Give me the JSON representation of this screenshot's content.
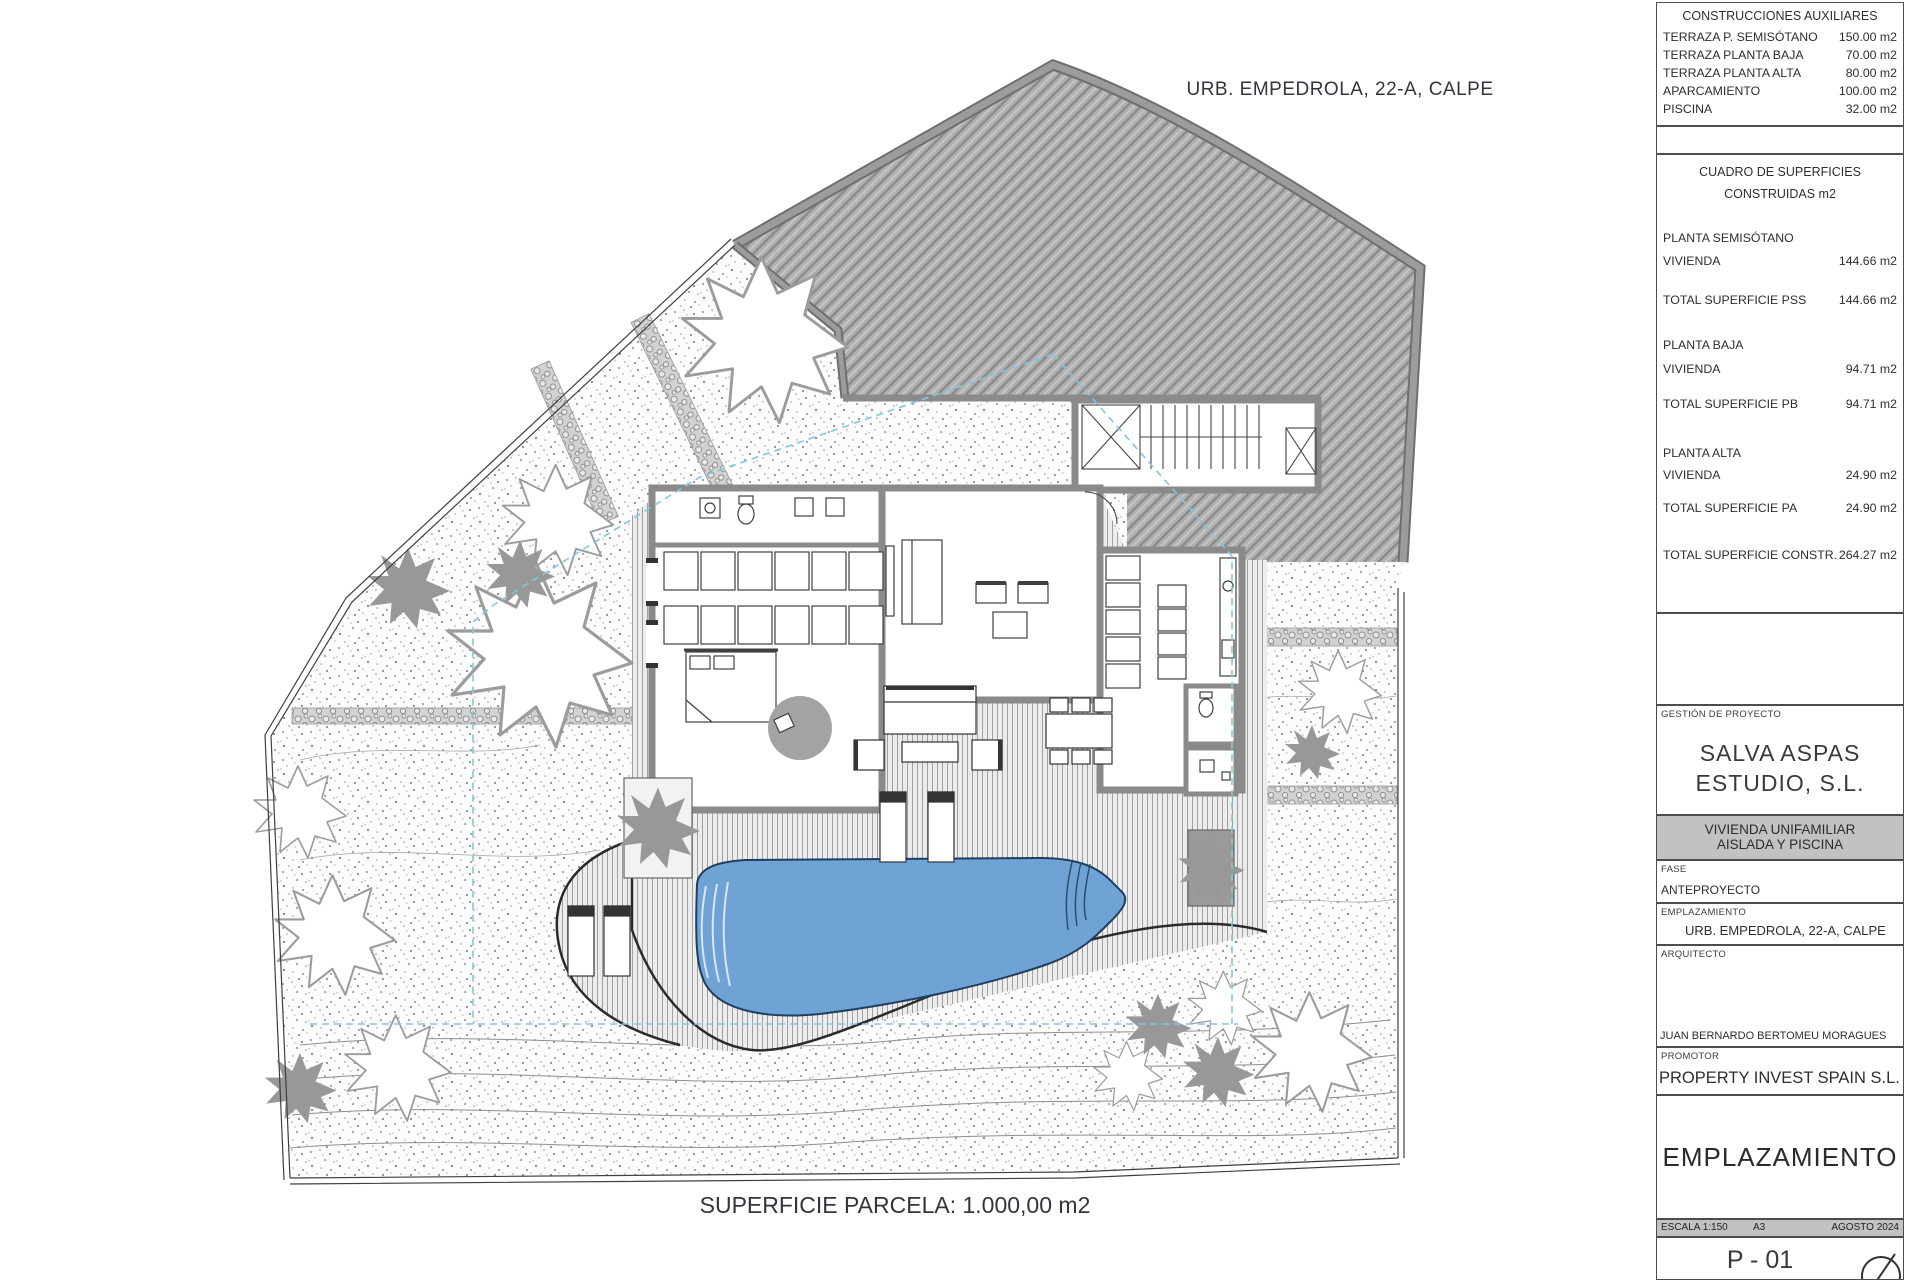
{
  "drawing": {
    "site_label": "URB. EMPEDROLA, 22-A, CALPE",
    "parcel_label": "SUPERFICIE PARCELA: 1.000,00 m2"
  },
  "title_block": {
    "aux_table": {
      "title": "CONSTRUCCIONES AUXILIARES",
      "rows": [
        {
          "label": "TERRAZA P. SEMISÓTANO",
          "value": "150.00 m2"
        },
        {
          "label": "TERRAZA PLANTA BAJA",
          "value": "70.00 m2"
        },
        {
          "label": "TERRAZA PLANTA ALTA",
          "value": "80.00 m2"
        },
        {
          "label": "APARCAMIENTO",
          "value": "100.00 m2"
        },
        {
          "label": "PISCINA",
          "value": "32.00 m2"
        }
      ]
    },
    "surfaces": {
      "title_line1": "CUADRO DE SUPERFICIES",
      "title_line2": "CONSTRUIDAS m2",
      "sections": [
        {
          "heading": "PLANTA SEMISÓTANO",
          "row_label": "VIVIENDA",
          "row_value": "144.66 m2",
          "total_label": "TOTAL SUPERFICIE PSS",
          "total_value": "144.66 m2"
        },
        {
          "heading": "PLANTA BAJA",
          "row_label": "VIVIENDA",
          "row_value": "94.71 m2",
          "total_label": "TOTAL SUPERFICIE PB",
          "total_value": "94.71 m2"
        },
        {
          "heading": "PLANTA ALTA",
          "row_label": "VIVIENDA",
          "row_value": "24.90 m2",
          "total_label": "TOTAL SUPERFICIE PA",
          "total_value": "24.90 m2"
        }
      ],
      "grand_total_label": "TOTAL SUPERFICIE CONSTR.",
      "grand_total_value": "264.27 m2"
    },
    "management_label": "GESTIÓN DE PROYECTO",
    "studio_line1": "SALVA ASPAS",
    "studio_line2": "ESTUDIO, S.L.",
    "project_line1": "VIVIENDA UNIFAMILIAR",
    "project_line2": "AISLADA Y PISCINA",
    "fase_label": "FASE",
    "fase_value": "ANTEPROYECTO",
    "emplazamiento_label": "EMPLAZAMIENTO",
    "emplazamiento_value": "URB. EMPEDROLA, 22-A, CALPE",
    "arquitecto_label": "ARQUITECTO",
    "arquitecto_value": "JUAN BERNARDO BERTOMEU MORAGUES",
    "promotor_label": "PROMOTOR",
    "promotor_value": "PROPERTY INVEST SPAIN S.L.",
    "sheet_title": "EMPLAZAMIENTO",
    "meta": {
      "escala": "ESCALA 1:150",
      "formato": "A3",
      "fecha": "AGOSTO 2024"
    },
    "sheet_number": "P - 01"
  },
  "colors": {
    "pool_blue": "#6FA3D6",
    "setback_cyan": "#7EC8E0",
    "wall_gray": "#8A8A8A",
    "slope_hatch_gray": "#8F8F8F",
    "band_gray": "#C2C2C2",
    "outline_dark": "#2B2B2B"
  }
}
